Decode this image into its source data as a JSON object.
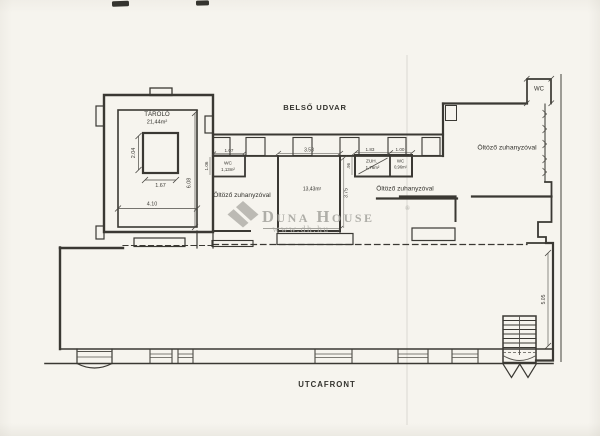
{
  "document": {
    "courtyard_label": "BELSŐ UDVAR",
    "street_label": "UTCAFRONT"
  },
  "rooms": {
    "storage": {
      "name": "TÁROLÓ",
      "area": "21,44m²"
    },
    "wc_small": {
      "name": "WC",
      "area": "1,13m²"
    },
    "dressing_left": {
      "label": "Öltöző zuhanyzóval"
    },
    "room_mid": {
      "area": "13,43m²"
    },
    "shower": {
      "name": "ZUH.",
      "area": "1,76m²"
    },
    "wc_mid": {
      "name": "WC",
      "area": "0,96m²"
    },
    "dressing_mid": {
      "label": "Öltöző zuhanyzóval"
    },
    "dressing_right": {
      "label": "Öltöző zuhanyzóval"
    },
    "wc_right": {
      "name": "WC"
    }
  },
  "dimensions": {
    "storage_core_width": "1.67",
    "storage_core_height": "2.04",
    "storage_width": "4.10",
    "storage_height": "6.08",
    "wc_small_width": "1.07",
    "wc_small_height": "1.06",
    "room_mid_width": "3.58",
    "room_mid_height": "3.75",
    "shower_width": "1.83",
    "wc_mid_width": "1.00",
    "shower_height": ".96",
    "right_side_height": "5.05"
  },
  "watermark": {
    "brand": "Duna House",
    "registered": "®",
    "url": "www.dh.hu"
  },
  "colors": {
    "paper": "#f6f4ee",
    "ink": "#3a3833",
    "watermark": "#a3a29c"
  }
}
